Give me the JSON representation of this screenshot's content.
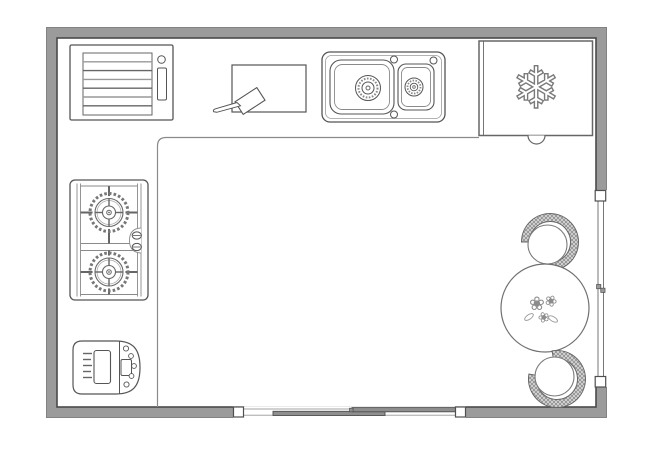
{
  "diagram": {
    "type": "kitchen-floor-plan",
    "colors": {
      "background": "#ffffff",
      "wall_fill": "#9b9b9b",
      "wall_outer_edge": "#828282",
      "wall_inner_edge": "#4a4a4a",
      "outline": "#555555",
      "light_line": "#8a8a8a",
      "hatch_line": "#8f8f8f",
      "hatch_bg": "#dedede",
      "door_panel": "#8f8f8f"
    },
    "objects": [
      {
        "name": "walls",
        "shape": "rectangular-room"
      },
      {
        "name": "window",
        "wall": "right"
      },
      {
        "name": "sliding-door",
        "wall": "bottom",
        "panels": 2
      },
      {
        "name": "counter",
        "shape": "L"
      },
      {
        "name": "dishwasher",
        "area": "counter-top-left"
      },
      {
        "name": "cutting-board",
        "items": [
          "knife"
        ]
      },
      {
        "name": "double-sink",
        "basins": 2
      },
      {
        "name": "refrigerator",
        "icon": "snowflake"
      },
      {
        "name": "gas-cooktop",
        "burners": 2,
        "knobs": 2
      },
      {
        "name": "bread-maker",
        "buttons": 5
      },
      {
        "name": "dining-table",
        "shape": "round",
        "centerpiece": "flowers"
      },
      {
        "name": "chair",
        "count": 2,
        "back": "hatched-arc"
      }
    ]
  },
  "icons": {
    "snowflake": "❄",
    "flower": "❀"
  }
}
